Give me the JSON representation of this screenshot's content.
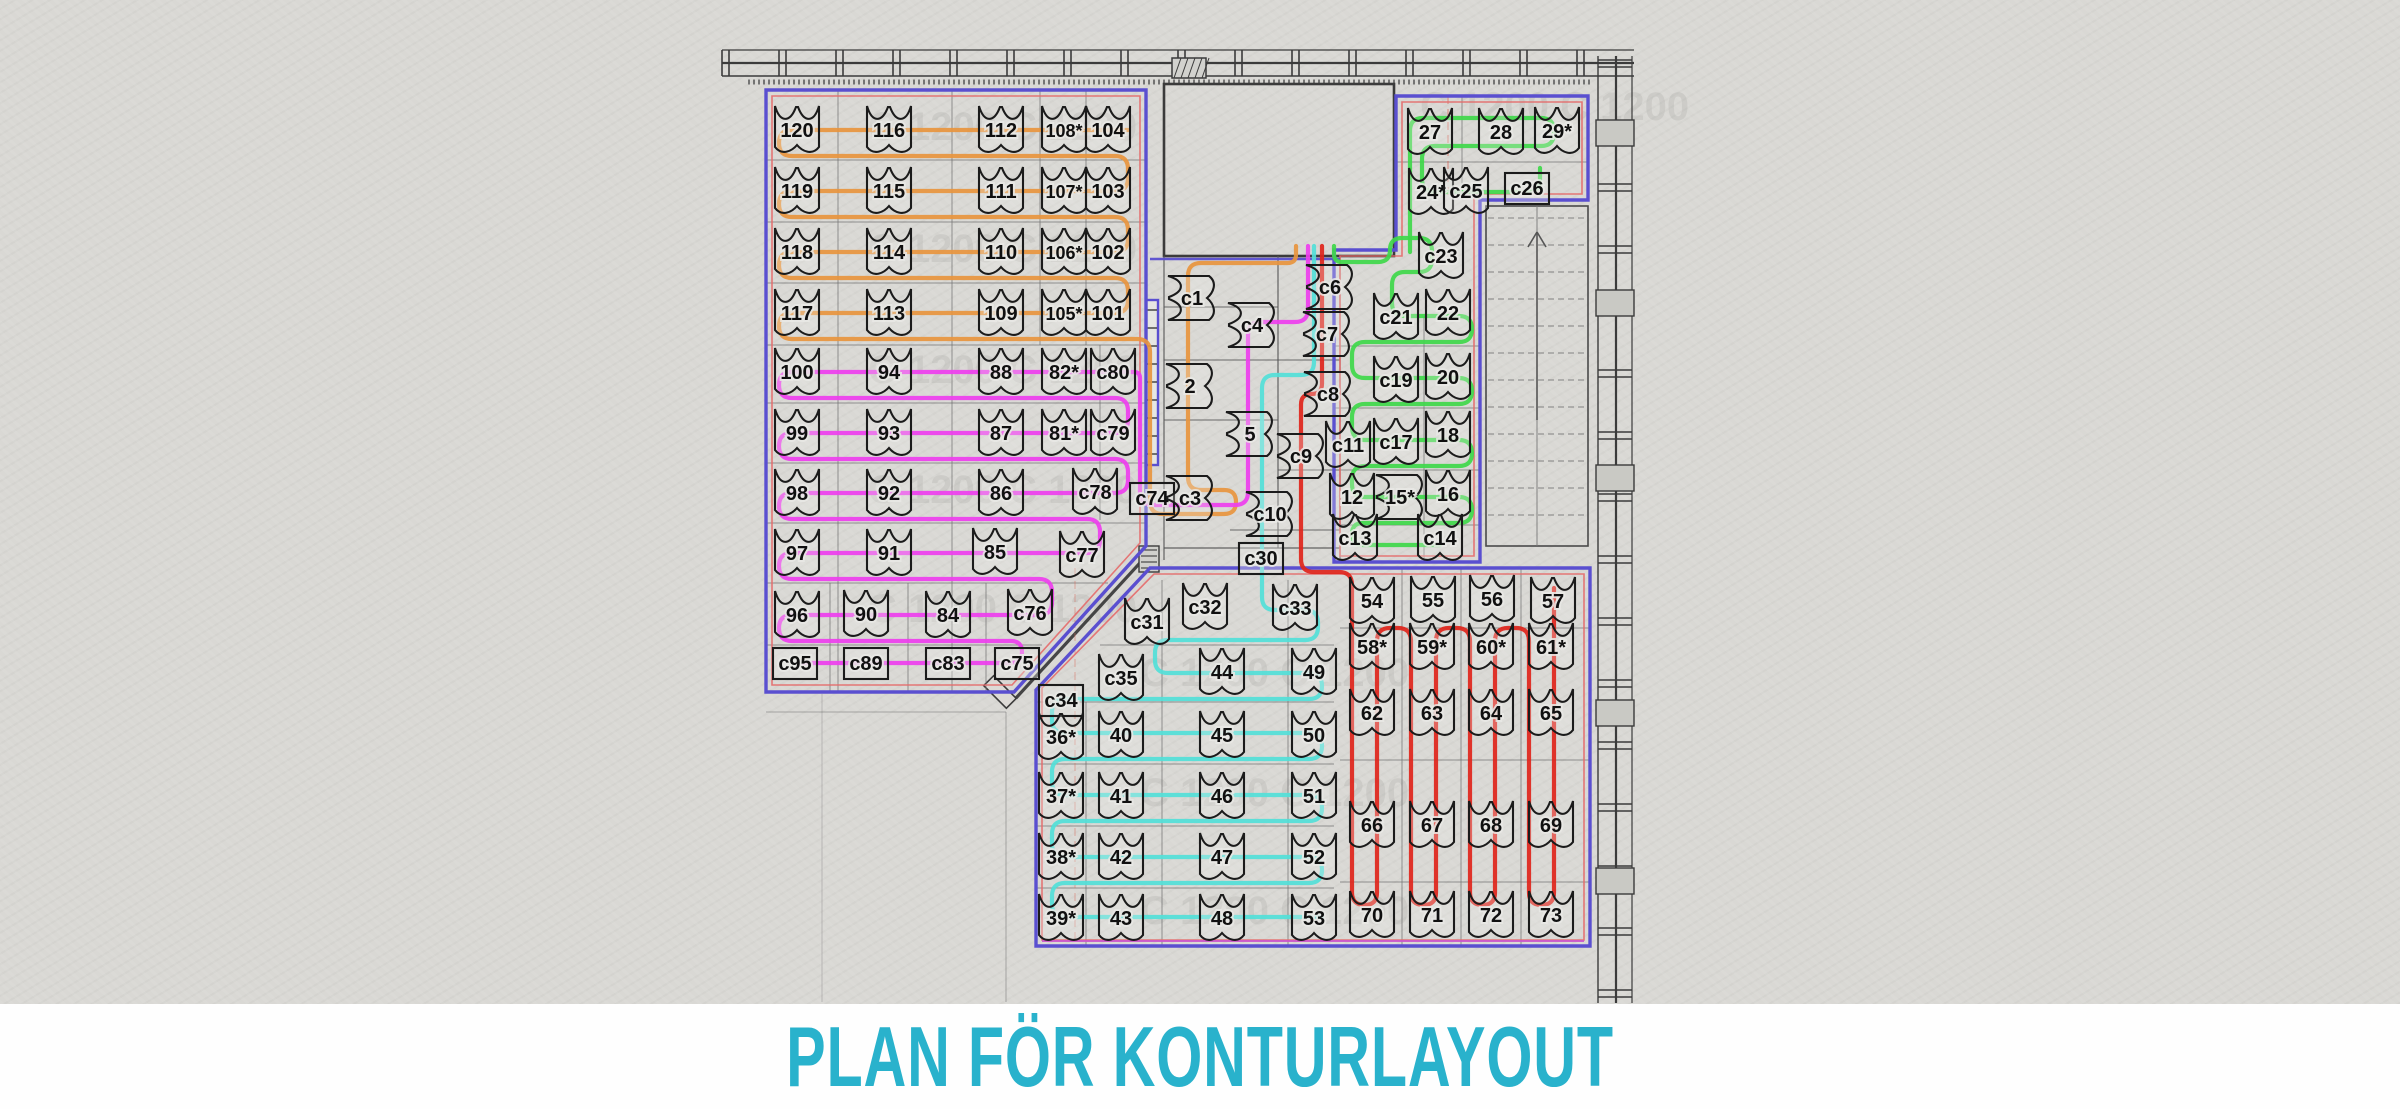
{
  "title": {
    "text": "PLAN FÖR KONTURLAYOUT",
    "color": "#29b2cc"
  },
  "colors": {
    "paper": "#d9d8d4",
    "wall": "#3b3b3b",
    "grid": "#6e6e6e",
    "zone_border": "#5a4fd0",
    "zone_inner": "#e46a6a",
    "zone_inner_pink": "#cc55cc",
    "route_orange": "#e8953e",
    "route_magenta": "#ee3eee",
    "route_cyan": "#52dfd8",
    "route_red": "#e0251b",
    "route_green": "#3fd84a",
    "title_cyan": "#29b2cc"
  },
  "watermark": {
    "text": "C 1200 C 1200"
  },
  "plan": {
    "groups": [
      {
        "name": "zone-orange",
        "route": "route_orange",
        "seats": [
          {
            "label": "120",
            "x": 797,
            "y": 130
          },
          {
            "label": "116",
            "x": 889,
            "y": 130
          },
          {
            "label": "112",
            "x": 1001,
            "y": 130
          },
          {
            "label": "108*",
            "x": 1064,
            "y": 130
          },
          {
            "label": "104",
            "x": 1108,
            "y": 130
          },
          {
            "label": "119",
            "x": 797,
            "y": 191
          },
          {
            "label": "115",
            "x": 889,
            "y": 191
          },
          {
            "label": "111",
            "x": 1001,
            "y": 191
          },
          {
            "label": "107*",
            "x": 1064,
            "y": 191
          },
          {
            "label": "103",
            "x": 1108,
            "y": 191
          },
          {
            "label": "118",
            "x": 797,
            "y": 252
          },
          {
            "label": "114",
            "x": 889,
            "y": 252
          },
          {
            "label": "110",
            "x": 1001,
            "y": 252
          },
          {
            "label": "106*",
            "x": 1064,
            "y": 252
          },
          {
            "label": "102",
            "x": 1108,
            "y": 252
          },
          {
            "label": "117",
            "x": 797,
            "y": 313
          },
          {
            "label": "113",
            "x": 889,
            "y": 313
          },
          {
            "label": "109",
            "x": 1001,
            "y": 313
          },
          {
            "label": "105*",
            "x": 1064,
            "y": 313
          },
          {
            "label": "101",
            "x": 1108,
            "y": 313
          }
        ]
      },
      {
        "name": "zone-magenta",
        "route": "route_magenta",
        "seats": [
          {
            "label": "100",
            "x": 797,
            "y": 372
          },
          {
            "label": "94",
            "x": 889,
            "y": 372
          },
          {
            "label": "88",
            "x": 1001,
            "y": 372
          },
          {
            "label": "82*",
            "x": 1064,
            "y": 372
          },
          {
            "label": "c80",
            "x": 1113,
            "y": 372
          },
          {
            "label": "99",
            "x": 797,
            "y": 433
          },
          {
            "label": "93",
            "x": 889,
            "y": 433
          },
          {
            "label": "87",
            "x": 1001,
            "y": 433
          },
          {
            "label": "81*",
            "x": 1064,
            "y": 433
          },
          {
            "label": "c79",
            "x": 1113,
            "y": 433
          },
          {
            "label": "98",
            "x": 797,
            "y": 493
          },
          {
            "label": "92",
            "x": 889,
            "y": 493
          },
          {
            "label": "86",
            "x": 1001,
            "y": 493
          },
          {
            "label": "c78",
            "x": 1095,
            "y": 492
          },
          {
            "label": "97",
            "x": 797,
            "y": 553
          },
          {
            "label": "91",
            "x": 889,
            "y": 553
          },
          {
            "label": "85",
            "x": 995,
            "y": 552
          },
          {
            "label": "c77",
            "x": 1082,
            "y": 555
          },
          {
            "label": "96",
            "x": 797,
            "y": 615
          },
          {
            "label": "90",
            "x": 866,
            "y": 614
          },
          {
            "label": "84",
            "x": 948,
            "y": 615
          },
          {
            "label": "c76",
            "x": 1030,
            "y": 613
          },
          {
            "label": "c95",
            "x": 795,
            "y": 663,
            "o": "r"
          },
          {
            "label": "c89",
            "x": 866,
            "y": 663,
            "o": "r"
          },
          {
            "label": "c83",
            "x": 948,
            "y": 663,
            "o": "r"
          },
          {
            "label": "c75",
            "x": 1017,
            "y": 663,
            "o": "r"
          }
        ]
      },
      {
        "name": "zone-corridor",
        "route": "route_orange",
        "seats": [
          {
            "label": "c1",
            "x": 1192,
            "y": 298,
            "o": "h"
          },
          {
            "label": "c6",
            "x": 1330,
            "y": 287,
            "o": "h"
          },
          {
            "label": "c4",
            "x": 1252,
            "y": 325,
            "o": "h"
          },
          {
            "label": "c7",
            "x": 1327,
            "y": 334,
            "o": "h"
          },
          {
            "label": "2",
            "x": 1190,
            "y": 386,
            "o": "h"
          },
          {
            "label": "c8",
            "x": 1328,
            "y": 394,
            "o": "h"
          },
          {
            "label": "5",
            "x": 1250,
            "y": 434,
            "o": "h"
          },
          {
            "label": "c9",
            "x": 1301,
            "y": 456,
            "o": "h"
          },
          {
            "label": "c74",
            "x": 1152,
            "y": 498,
            "o": "r"
          },
          {
            "label": "c3",
            "x": 1190,
            "y": 498,
            "o": "h"
          },
          {
            "label": "c10",
            "x": 1270,
            "y": 514,
            "o": "h"
          },
          {
            "label": "c30",
            "x": 1261,
            "y": 558,
            "o": "r"
          }
        ]
      },
      {
        "name": "zone-green",
        "route": "route_green",
        "seats": [
          {
            "label": "27",
            "x": 1430,
            "y": 132
          },
          {
            "label": "28",
            "x": 1501,
            "y": 132
          },
          {
            "label": "29*",
            "x": 1557,
            "y": 131
          },
          {
            "label": "24*",
            "x": 1431,
            "y": 192
          },
          {
            "label": "c25",
            "x": 1466,
            "y": 191
          },
          {
            "label": "c26",
            "x": 1527,
            "y": 188,
            "o": "r"
          },
          {
            "label": "c23",
            "x": 1441,
            "y": 256
          },
          {
            "label": "c21",
            "x": 1396,
            "y": 317
          },
          {
            "label": "22",
            "x": 1448,
            "y": 313
          },
          {
            "label": "c19",
            "x": 1396,
            "y": 380
          },
          {
            "label": "20",
            "x": 1448,
            "y": 377
          },
          {
            "label": "c11",
            "x": 1348,
            "y": 445
          },
          {
            "label": "c17",
            "x": 1396,
            "y": 442
          },
          {
            "label": "18",
            "x": 1448,
            "y": 435
          },
          {
            "label": "12",
            "x": 1352,
            "y": 497
          },
          {
            "label": "15*",
            "x": 1400,
            "y": 497,
            "o": "h"
          },
          {
            "label": "16",
            "x": 1448,
            "y": 494
          },
          {
            "label": "c13",
            "x": 1355,
            "y": 538
          },
          {
            "label": "c14",
            "x": 1440,
            "y": 538
          }
        ]
      },
      {
        "name": "zone-cyan",
        "route": "route_cyan",
        "seats": [
          {
            "label": "c31",
            "x": 1147,
            "y": 622
          },
          {
            "label": "c32",
            "x": 1205,
            "y": 607
          },
          {
            "label": "c33",
            "x": 1295,
            "y": 608
          },
          {
            "label": "c35",
            "x": 1121,
            "y": 678
          },
          {
            "label": "44",
            "x": 1222,
            "y": 672
          },
          {
            "label": "49",
            "x": 1314,
            "y": 672
          },
          {
            "label": "c34",
            "x": 1061,
            "y": 700,
            "o": "r"
          },
          {
            "label": "36*",
            "x": 1061,
            "y": 737
          },
          {
            "label": "40",
            "x": 1121,
            "y": 735
          },
          {
            "label": "45",
            "x": 1222,
            "y": 735
          },
          {
            "label": "50",
            "x": 1314,
            "y": 735
          },
          {
            "label": "37*",
            "x": 1061,
            "y": 796
          },
          {
            "label": "41",
            "x": 1121,
            "y": 796
          },
          {
            "label": "46",
            "x": 1222,
            "y": 796
          },
          {
            "label": "51",
            "x": 1314,
            "y": 796
          },
          {
            "label": "38*",
            "x": 1061,
            "y": 857
          },
          {
            "label": "42",
            "x": 1121,
            "y": 857
          },
          {
            "label": "47",
            "x": 1222,
            "y": 857
          },
          {
            "label": "52",
            "x": 1314,
            "y": 857
          },
          {
            "label": "39*",
            "x": 1061,
            "y": 918
          },
          {
            "label": "43",
            "x": 1121,
            "y": 918
          },
          {
            "label": "48",
            "x": 1222,
            "y": 918
          },
          {
            "label": "53",
            "x": 1314,
            "y": 918
          }
        ]
      },
      {
        "name": "zone-red",
        "route": "route_red",
        "seats": [
          {
            "label": "54",
            "x": 1372,
            "y": 601
          },
          {
            "label": "55",
            "x": 1433,
            "y": 600
          },
          {
            "label": "56",
            "x": 1492,
            "y": 599
          },
          {
            "label": "57",
            "x": 1553,
            "y": 601
          },
          {
            "label": "58*",
            "x": 1372,
            "y": 647
          },
          {
            "label": "59*",
            "x": 1432,
            "y": 647
          },
          {
            "label": "60*",
            "x": 1491,
            "y": 647
          },
          {
            "label": "61*",
            "x": 1551,
            "y": 647
          },
          {
            "label": "62",
            "x": 1372,
            "y": 713
          },
          {
            "label": "63",
            "x": 1432,
            "y": 713
          },
          {
            "label": "64",
            "x": 1491,
            "y": 713
          },
          {
            "label": "65",
            "x": 1551,
            "y": 713
          },
          {
            "label": "66",
            "x": 1372,
            "y": 825
          },
          {
            "label": "67",
            "x": 1432,
            "y": 825
          },
          {
            "label": "68",
            "x": 1491,
            "y": 825
          },
          {
            "label": "69",
            "x": 1551,
            "y": 825
          },
          {
            "label": "70",
            "x": 1372,
            "y": 915
          },
          {
            "label": "71",
            "x": 1432,
            "y": 915
          },
          {
            "label": "72",
            "x": 1491,
            "y": 915
          },
          {
            "label": "73",
            "x": 1551,
            "y": 915
          }
        ]
      }
    ]
  }
}
